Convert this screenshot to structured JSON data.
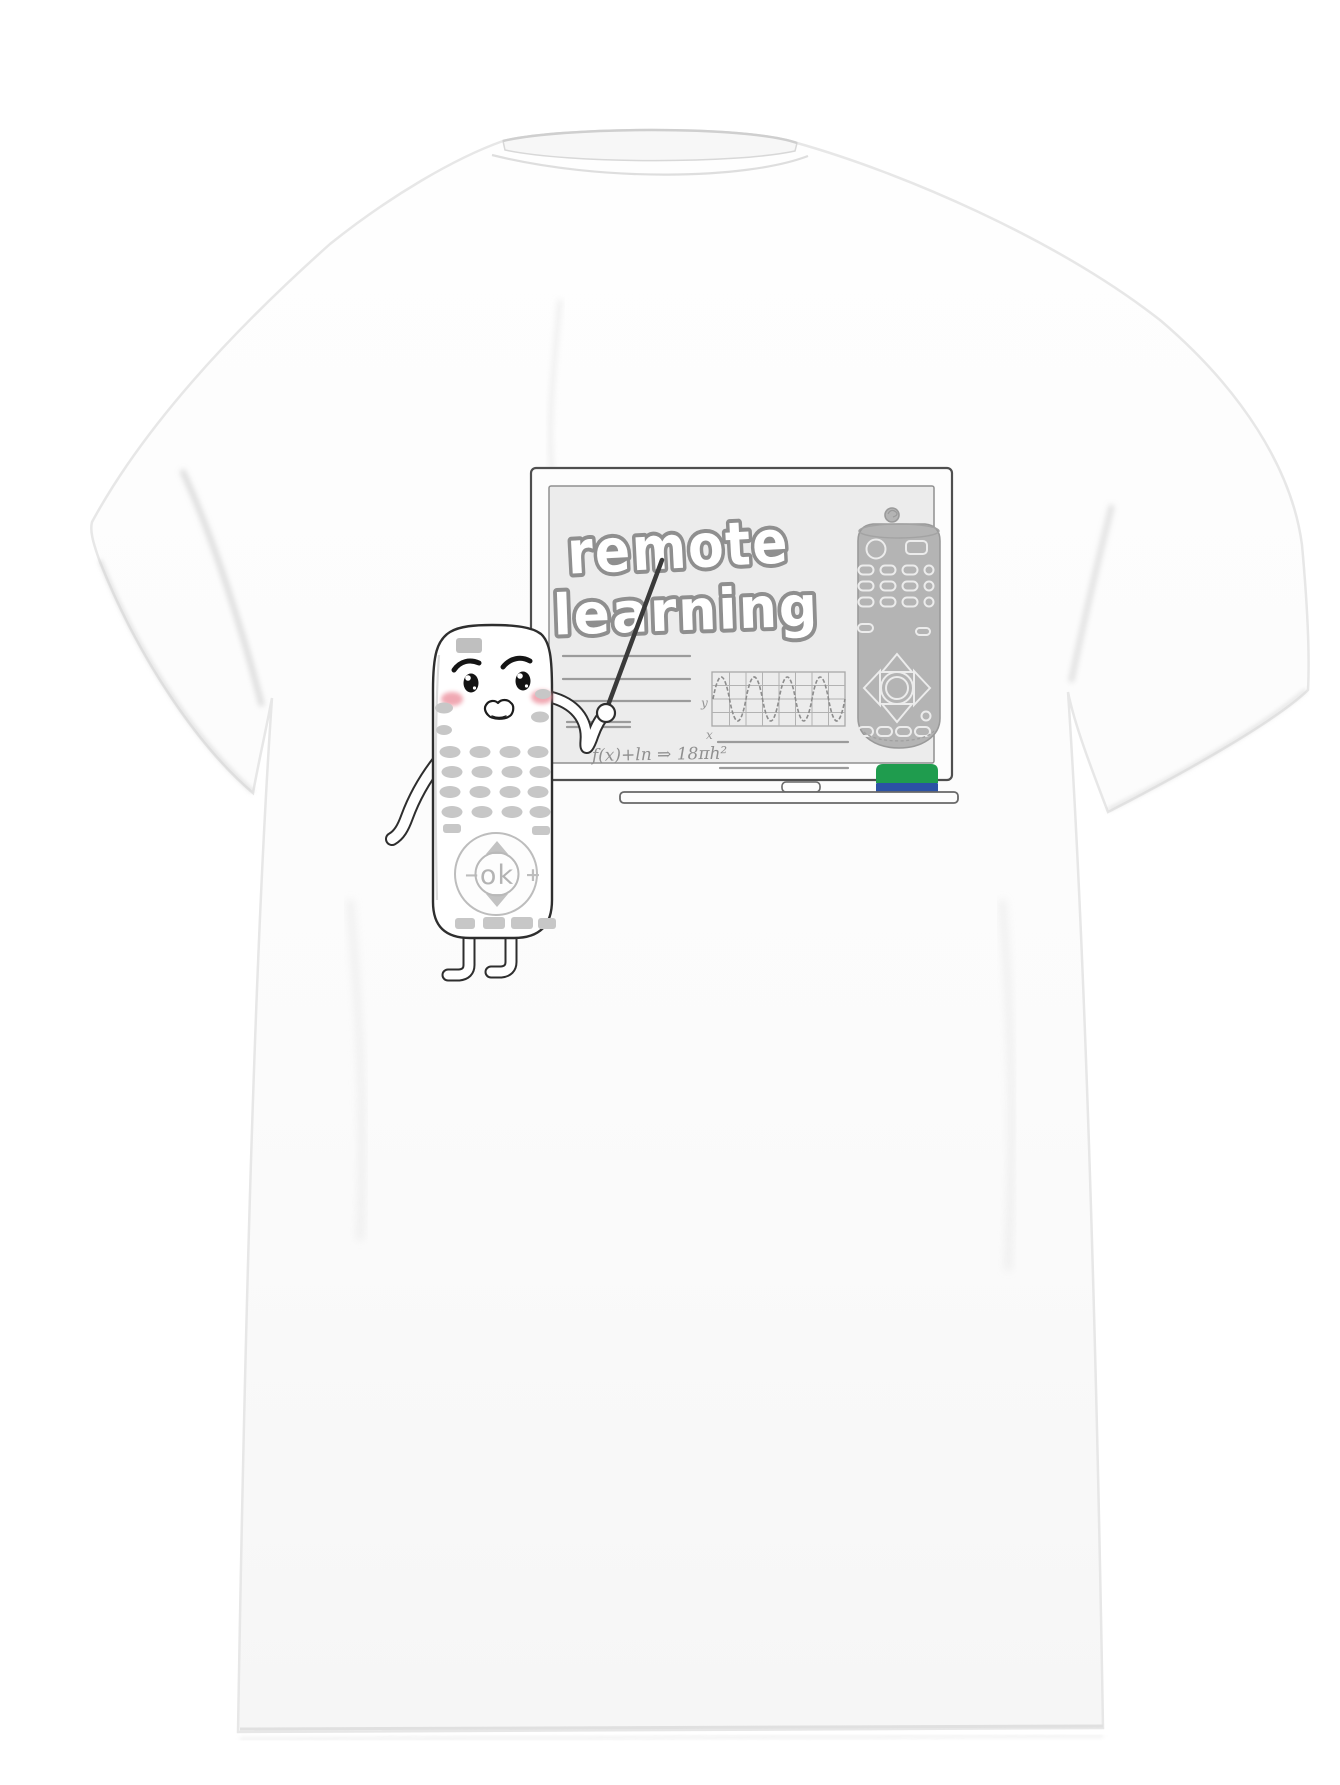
{
  "board": {
    "title_line1": "remote",
    "title_line2": "learning",
    "formula": "f(x)+ln ⇒ 18πh²",
    "axis_label_y": "y",
    "axis_label_x": "x"
  },
  "character": {
    "ok_label": "ok",
    "minus_label": "−",
    "plus_label": "+"
  },
  "colors": {
    "shirt": "#fcfcfc",
    "board_surface": "#ececec",
    "sketch_outline": "#8f8f8f",
    "remote_diagram_gray": "#b4b4b4",
    "blush_pink": "#ee9aa6",
    "buttons_gray": "#c6c6c6",
    "eraser_green": "#1f9c4e",
    "eraser_blue": "#2b52a5"
  },
  "icons": {
    "pointer_stick": "thin-dark-rod",
    "whiteboard_eraser": "green-blue-block",
    "tray_marker": "white-pill",
    "dpad_up": "triangle-up",
    "dpad_down": "triangle-down",
    "power_button": "circle-outline"
  }
}
